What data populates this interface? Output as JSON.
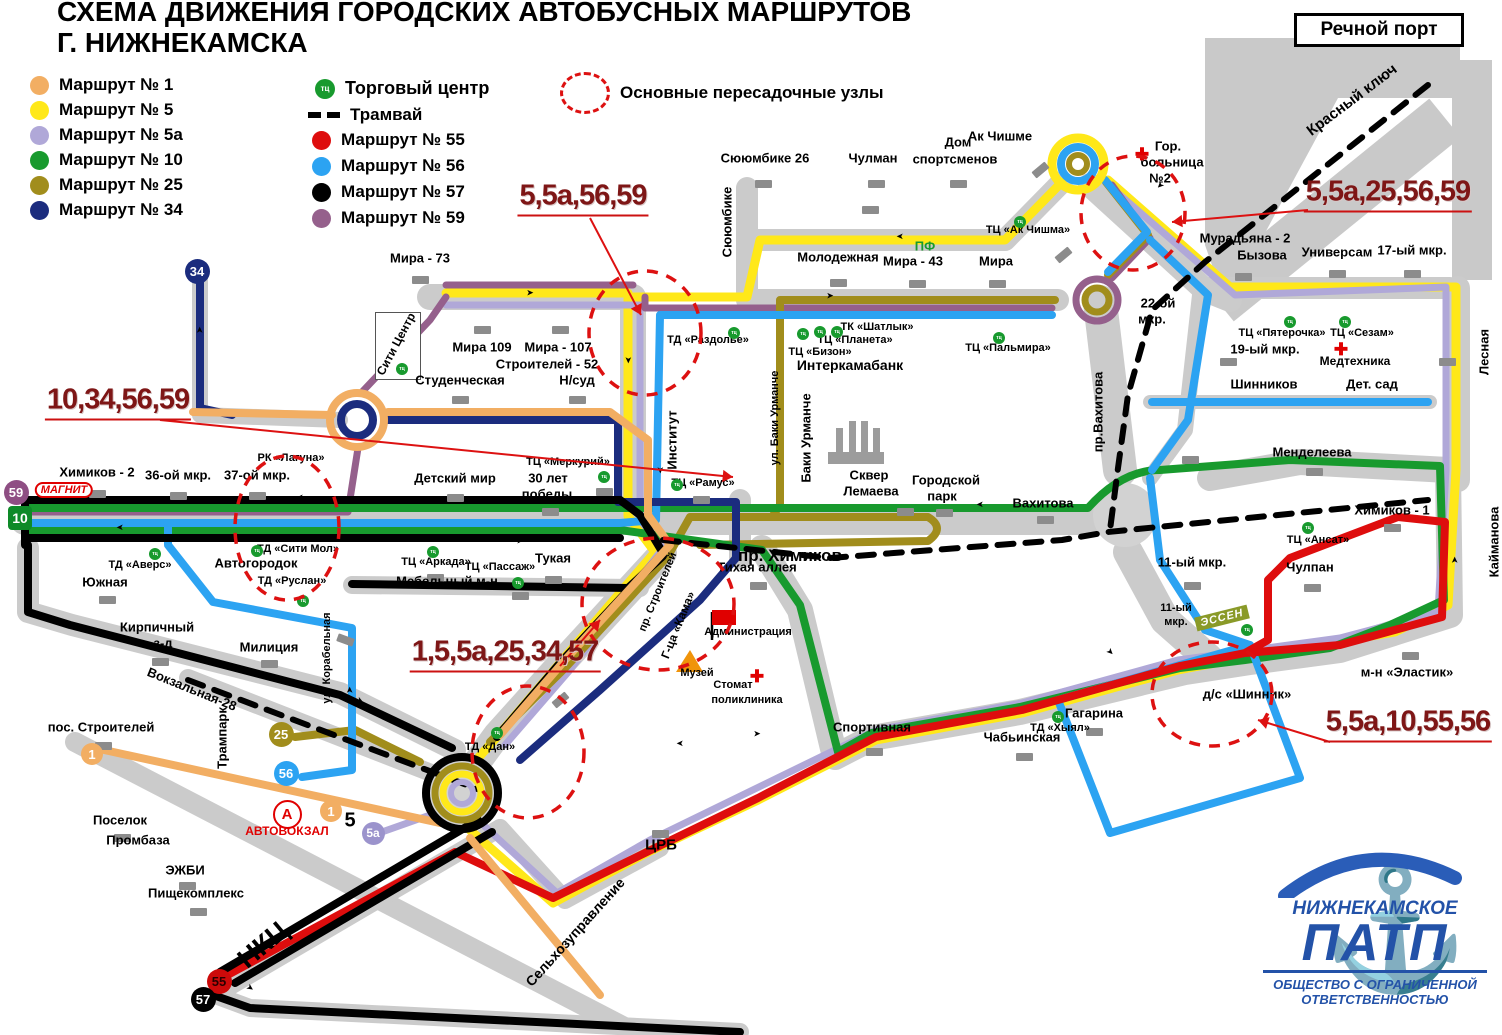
{
  "title": {
    "line1": "СХЕМА ДВИЖЕНИЯ ГОРОДСКИХ АВТОБУСНЫХ МАРШРУТОВ",
    "line2": "Г. НИЖНЕКАМСКА"
  },
  "corner_box": {
    "label": "Речной порт"
  },
  "legend": {
    "routes_col1": [
      {
        "label": "Маршрут № 1",
        "color": "#F2AE63"
      },
      {
        "label": "Маршрут № 5",
        "color": "#FFE819"
      },
      {
        "label": "Маршрут № 5а",
        "color": "#B0A8D8"
      },
      {
        "label": "Маршрут № 10",
        "color": "#189A2E"
      },
      {
        "label": "Маршрут № 25",
        "color": "#A18D1C"
      },
      {
        "label": "Маршрут № 34",
        "color": "#1B2C7E"
      }
    ],
    "routes_col2": [
      {
        "label": "Маршрут № 55",
        "color": "#DE0D0D"
      },
      {
        "label": "Маршрут № 56",
        "color": "#2CA3F2"
      },
      {
        "label": "Маршрут № 57",
        "color": "#000000"
      },
      {
        "label": "Маршрут № 59",
        "color": "#95608C"
      }
    ],
    "tc": {
      "badge": "тц",
      "label": "Торговый центр"
    },
    "tram": {
      "label": "Трамвай"
    },
    "hubs": {
      "label": "Основные пересадочные узлы"
    }
  },
  "junctions": [
    {
      "t": "5,5а,56,59",
      "x": 583,
      "y": 196,
      "ax1": 590,
      "ay1": 218,
      "ax2": 641,
      "ay2": 315
    },
    {
      "t": "10,34,56,59",
      "x": 118,
      "y": 400,
      "ax1": 160,
      "ay1": 420,
      "ax2": 733,
      "ay2": 477
    },
    {
      "t": "1,5,5а,25,34,57",
      "x": 505,
      "y": 652,
      "ax1": 560,
      "ay1": 666,
      "ax2": 600,
      "ay2": 620
    },
    {
      "t": "5,5а,25,56,59",
      "x": 1388,
      "y": 192,
      "ax1": 1308,
      "ay1": 210,
      "ax2": 1172,
      "ay2": 222
    },
    {
      "t": "5,5а,10,55,56",
      "x": 1408,
      "y": 722,
      "ax1": 1330,
      "ay1": 742,
      "ax2": 1258,
      "ay2": 720
    }
  ],
  "hubs": [
    {
      "cx": 645,
      "cy": 333,
      "rx": 56,
      "ry": 62
    },
    {
      "cx": 287,
      "cy": 528,
      "rx": 52,
      "ry": 72
    },
    {
      "cx": 1133,
      "cy": 213,
      "rx": 52,
      "ry": 57
    },
    {
      "cx": 658,
      "cy": 604,
      "rx": 76,
      "ry": 66
    },
    {
      "cx": 528,
      "cy": 752,
      "rx": 56,
      "ry": 66
    },
    {
      "cx": 1212,
      "cy": 694,
      "rx": 60,
      "ry": 52
    }
  ],
  "badges": [
    {
      "t": "34",
      "x": 197,
      "y": 271,
      "bg": "#1B2C7E",
      "fg": "#fff",
      "d": 25,
      "fs": 13
    },
    {
      "t": "59",
      "x": 16,
      "y": 492,
      "bg": "#8E4E83",
      "fg": "#fff",
      "d": 25,
      "fs": 13
    },
    {
      "t": "10",
      "x": 20,
      "y": 518,
      "bg": "#0E8A28",
      "fg": "#fff",
      "d": 24,
      "fs": 14,
      "shape": "rect"
    },
    {
      "t": "25",
      "x": 281,
      "y": 734,
      "bg": "#A18D1C",
      "fg": "#fff",
      "d": 25,
      "fs": 13
    },
    {
      "t": "56",
      "x": 286,
      "y": 773,
      "bg": "#2CA3F2",
      "fg": "#fff",
      "d": 25,
      "fs": 13
    },
    {
      "t": "1",
      "x": 92,
      "y": 754,
      "bg": "#F2AE63",
      "fg": "#fff",
      "d": 22,
      "fs": 13
    },
    {
      "t": "1",
      "x": 331,
      "y": 811,
      "bg": "#F2AE63",
      "fg": "#fff",
      "d": 22,
      "fs": 13
    },
    {
      "t": "5а",
      "x": 373,
      "y": 833,
      "bg": "#9B93CC",
      "fg": "#fff",
      "d": 23,
      "fs": 12
    },
    {
      "t": "А",
      "x": 285,
      "y": 812,
      "bg": "#fff",
      "fg": "#E00000",
      "d": 25,
      "fs": 15,
      "border": "#E00000"
    },
    {
      "t": "55",
      "x": 219,
      "y": 981,
      "bg": "#CC0A0A",
      "fg": "#2A0000",
      "d": 25,
      "fs": 13
    },
    {
      "t": "57",
      "x": 203,
      "y": 999,
      "bg": "#000",
      "fg": "#fff",
      "d": 25,
      "fs": 13
    }
  ],
  "magnit": {
    "t": "МАГНИТ",
    "x": 64,
    "y": 490
  },
  "essen": {
    "t": "ЭССЕН",
    "x": 1222,
    "y": 618
  },
  "labels": [
    {
      "t": "Мира - 73",
      "x": 420,
      "y": 258
    },
    {
      "t": "Сююмбике 26",
      "x": 765,
      "y": 158
    },
    {
      "t": "Чулман",
      "x": 873,
      "y": 158
    },
    {
      "t": "Дом",
      "x": 958,
      "y": 142
    },
    {
      "t": "спортсменов",
      "x": 955,
      "y": 159
    },
    {
      "t": "Ак Чишме",
      "x": 1000,
      "y": 136
    },
    {
      "t": "Гор.",
      "x": 1168,
      "y": 146
    },
    {
      "t": "больница",
      "x": 1172,
      "y": 162
    },
    {
      "t": "№2",
      "x": 1160,
      "y": 178
    },
    {
      "t": "Мурадьяна - 2",
      "x": 1245,
      "y": 238
    },
    {
      "t": "Бызова",
      "x": 1262,
      "y": 255
    },
    {
      "t": "Универсам",
      "x": 1337,
      "y": 252
    },
    {
      "t": "17-ый мкр.",
      "x": 1412,
      "y": 250
    },
    {
      "t": "Красный ключ",
      "x": 1352,
      "y": 100,
      "r": -37,
      "fs": 15
    },
    {
      "t": "Сююмбике",
      "x": 727,
      "y": 222,
      "r": -90
    },
    {
      "t": "Молодежная",
      "x": 838,
      "y": 257
    },
    {
      "t": "ПФ",
      "x": 925,
      "y": 246,
      "c": "#189A2E"
    },
    {
      "t": "Мира - 43",
      "x": 913,
      "y": 261
    },
    {
      "t": "Мира",
      "x": 996,
      "y": 261
    },
    {
      "t": "ТЦ «Ак Чишма»",
      "x": 1028,
      "y": 230,
      "fs": 11
    },
    {
      "t": "22-ой",
      "x": 1158,
      "y": 303
    },
    {
      "t": "мкр.",
      "x": 1152,
      "y": 319
    },
    {
      "t": "ТЦ «Пятерочка»",
      "x": 1282,
      "y": 333,
      "fs": 11
    },
    {
      "t": "ТЦ «Сезам»",
      "x": 1362,
      "y": 333,
      "fs": 11
    },
    {
      "t": "19-ый мкр.",
      "x": 1265,
      "y": 349
    },
    {
      "t": "Медтехника",
      "x": 1355,
      "y": 361,
      "fs": 12
    },
    {
      "t": "Шинников",
      "x": 1264,
      "y": 384
    },
    {
      "t": "Дет. сад",
      "x": 1372,
      "y": 384
    },
    {
      "t": "Лесная",
      "x": 1484,
      "y": 352,
      "r": -90
    },
    {
      "t": "Мира 109",
      "x": 482,
      "y": 347
    },
    {
      "t": "Мира - 107",
      "x": 558,
      "y": 347
    },
    {
      "t": "Строителей - 52",
      "x": 547,
      "y": 364
    },
    {
      "t": "Н/суд",
      "x": 577,
      "y": 380
    },
    {
      "t": "Студенческая",
      "x": 460,
      "y": 380
    },
    {
      "t": "Сити Центр",
      "x": 396,
      "y": 344,
      "r": -62,
      "fs": 12
    },
    {
      "t": "ТД «Раздолье»",
      "x": 708,
      "y": 340,
      "fs": 11
    },
    {
      "t": "ТК «Шатлык»",
      "x": 877,
      "y": 327,
      "fs": 11
    },
    {
      "t": "ТЦ «Планета»",
      "x": 855,
      "y": 340,
      "fs": 11
    },
    {
      "t": "ТЦ «Бизон»",
      "x": 820,
      "y": 352,
      "fs": 11
    },
    {
      "t": "Интеркамабанк",
      "x": 850,
      "y": 365,
      "fs": 14
    },
    {
      "t": "ТЦ «Пальмира»",
      "x": 1008,
      "y": 348,
      "fs": 11
    },
    {
      "t": "пр.Вахитова",
      "x": 1098,
      "y": 412,
      "r": -90
    },
    {
      "t": "Институт",
      "x": 672,
      "y": 440,
      "r": -90
    },
    {
      "t": "ул. Баки Урманче",
      "x": 775,
      "y": 418,
      "r": -90,
      "fs": 11
    },
    {
      "t": "Баки Урманче",
      "x": 806,
      "y": 438,
      "r": -90
    },
    {
      "t": "ТЦ «Рамус»",
      "x": 703,
      "y": 483,
      "fs": 11
    },
    {
      "t": "ТЦ «Меркурий»",
      "x": 568,
      "y": 462,
      "fs": 11
    },
    {
      "t": "30 лет",
      "x": 548,
      "y": 478
    },
    {
      "t": "победы",
      "x": 547,
      "y": 494
    },
    {
      "t": "Детский мир",
      "x": 455,
      "y": 478
    },
    {
      "t": "Химиков - 2",
      "x": 97,
      "y": 472
    },
    {
      "t": "36-ой мкр.",
      "x": 178,
      "y": 475
    },
    {
      "t": "37-ой мкр.",
      "x": 257,
      "y": 475
    },
    {
      "t": "РК «Лагуна»",
      "x": 291,
      "y": 458,
      "fs": 11
    },
    {
      "t": "ТД «Сити Мол»",
      "x": 298,
      "y": 549,
      "fs": 11
    },
    {
      "t": "Автогородок",
      "x": 256,
      "y": 563
    },
    {
      "t": "ТД «Аверс»",
      "x": 140,
      "y": 565,
      "fs": 11
    },
    {
      "t": "ТД «Руслан»",
      "x": 292,
      "y": 581,
      "fs": 11
    },
    {
      "t": "Южная",
      "x": 105,
      "y": 582
    },
    {
      "t": "Кирпичный",
      "x": 157,
      "y": 627
    },
    {
      "t": "з-д",
      "x": 163,
      "y": 643
    },
    {
      "t": "Милиция",
      "x": 269,
      "y": 647
    },
    {
      "t": "ул. Корабельная",
      "x": 327,
      "y": 658,
      "r": -90,
      "fs": 11
    },
    {
      "t": "Вокзальная-28",
      "x": 192,
      "y": 689,
      "r": 22
    },
    {
      "t": "Трампарк",
      "x": 222,
      "y": 738,
      "r": -90
    },
    {
      "t": "пос. Строителей",
      "x": 101,
      "y": 727
    },
    {
      "t": "Тукая",
      "x": 553,
      "y": 558
    },
    {
      "t": "ТЦ «Аркада»",
      "x": 436,
      "y": 562,
      "fs": 11
    },
    {
      "t": "ТЦ «Пассаж»",
      "x": 500,
      "y": 567,
      "fs": 11
    },
    {
      "t": "Мебельный м-н",
      "x": 447,
      "y": 581
    },
    {
      "t": "Тихая аллея",
      "x": 757,
      "y": 567
    },
    {
      "t": "пр. Химиков",
      "x": 790,
      "y": 556,
      "fs": 17
    },
    {
      "t": "пр. Строителей",
      "x": 658,
      "y": 592,
      "r": -68,
      "fs": 11
    },
    {
      "t": "Г-ца «Кама»",
      "x": 678,
      "y": 625,
      "r": -68,
      "fs": 12
    },
    {
      "t": "Администрация",
      "x": 748,
      "y": 632,
      "fs": 11
    },
    {
      "t": "Музей",
      "x": 697,
      "y": 673,
      "fs": 11
    },
    {
      "t": "Стомат",
      "x": 733,
      "y": 685,
      "fs": 11
    },
    {
      "t": "поликлиника",
      "x": 747,
      "y": 700,
      "fs": 11
    },
    {
      "t": "Сквер",
      "x": 869,
      "y": 475
    },
    {
      "t": "Лемаева",
      "x": 871,
      "y": 491
    },
    {
      "t": "Городской",
      "x": 946,
      "y": 480
    },
    {
      "t": "парк",
      "x": 942,
      "y": 496
    },
    {
      "t": "Вахитова",
      "x": 1043,
      "y": 503
    },
    {
      "t": "Менделеева",
      "x": 1312,
      "y": 452
    },
    {
      "t": "11-ый мкр.",
      "x": 1192,
      "y": 562
    },
    {
      "t": "11-ый",
      "x": 1176,
      "y": 608,
      "fs": 11
    },
    {
      "t": "мкр.",
      "x": 1176,
      "y": 622,
      "fs": 11
    },
    {
      "t": "ТЦ «Ансат»",
      "x": 1318,
      "y": 540,
      "fs": 11
    },
    {
      "t": "Химиков - 1",
      "x": 1392,
      "y": 510
    },
    {
      "t": "Чулпан",
      "x": 1310,
      "y": 567
    },
    {
      "t": "Кайманова",
      "x": 1494,
      "y": 542,
      "r": -90
    },
    {
      "t": "м-н «Эластик»",
      "x": 1407,
      "y": 672
    },
    {
      "t": "д/с «Шинник»",
      "x": 1247,
      "y": 694
    },
    {
      "t": "Гагарина",
      "x": 1094,
      "y": 713
    },
    {
      "t": "ТД «Хыял»",
      "x": 1060,
      "y": 728,
      "fs": 11
    },
    {
      "t": "Чабьинская",
      "x": 1022,
      "y": 737
    },
    {
      "t": "Спортивная",
      "x": 872,
      "y": 727
    },
    {
      "t": "ЦРБ",
      "x": 661,
      "y": 845,
      "fs": 15
    },
    {
      "t": "Сельхозуправление",
      "x": 575,
      "y": 932,
      "r": -48,
      "fs": 14
    },
    {
      "t": "НКЦ",
      "x": 263,
      "y": 945,
      "r": -40,
      "fs": 27
    },
    {
      "t": "Поселок",
      "x": 120,
      "y": 820
    },
    {
      "t": "Промбаза",
      "x": 138,
      "y": 840
    },
    {
      "t": "ЭЖБИ",
      "x": 185,
      "y": 870
    },
    {
      "t": "Пищекомплекс",
      "x": 196,
      "y": 893
    },
    {
      "t": "АВТОВОКЗАЛ",
      "x": 287,
      "y": 831,
      "fs": 12,
      "c": "#E00000"
    },
    {
      "t": "ТД «Дан»",
      "x": 490,
      "y": 747,
      "fs": 11
    },
    {
      "t": "5",
      "x": 350,
      "y": 821,
      "fs": 20
    }
  ],
  "tc_dots": [
    {
      "x": 402,
      "y": 369
    },
    {
      "x": 734,
      "y": 333
    },
    {
      "x": 803,
      "y": 334
    },
    {
      "x": 820,
      "y": 332
    },
    {
      "x": 837,
      "y": 332
    },
    {
      "x": 999,
      "y": 338
    },
    {
      "x": 1020,
      "y": 222
    },
    {
      "x": 1290,
      "y": 322
    },
    {
      "x": 1345,
      "y": 322
    },
    {
      "x": 677,
      "y": 485
    },
    {
      "x": 604,
      "y": 477
    },
    {
      "x": 257,
      "y": 551
    },
    {
      "x": 155,
      "y": 554
    },
    {
      "x": 303,
      "y": 601
    },
    {
      "x": 433,
      "y": 552
    },
    {
      "x": 518,
      "y": 583
    },
    {
      "x": 1308,
      "y": 528
    },
    {
      "x": 1058,
      "y": 717
    },
    {
      "x": 497,
      "y": 733
    },
    {
      "x": 1247,
      "y": 630
    }
  ],
  "crosses": [
    {
      "x": 1142,
      "y": 155
    },
    {
      "x": 1341,
      "y": 350
    },
    {
      "x": 757,
      "y": 677
    }
  ],
  "ticks": [
    {
      "x": 420,
      "y": 280
    },
    {
      "x": 763,
      "y": 184
    },
    {
      "x": 876,
      "y": 184
    },
    {
      "x": 958,
      "y": 184
    },
    {
      "x": 1040,
      "y": 170,
      "r": -40
    },
    {
      "x": 1243,
      "y": 277
    },
    {
      "x": 1337,
      "y": 274
    },
    {
      "x": 1412,
      "y": 274
    },
    {
      "x": 838,
      "y": 283
    },
    {
      "x": 917,
      "y": 284
    },
    {
      "x": 997,
      "y": 284
    },
    {
      "x": 1063,
      "y": 255,
      "r": -40
    },
    {
      "x": 482,
      "y": 330
    },
    {
      "x": 560,
      "y": 330
    },
    {
      "x": 577,
      "y": 400
    },
    {
      "x": 460,
      "y": 400
    },
    {
      "x": 97,
      "y": 494
    },
    {
      "x": 178,
      "y": 496
    },
    {
      "x": 257,
      "y": 496
    },
    {
      "x": 701,
      "y": 500
    },
    {
      "x": 604,
      "y": 492
    },
    {
      "x": 550,
      "y": 512
    },
    {
      "x": 455,
      "y": 498
    },
    {
      "x": 435,
      "y": 578
    },
    {
      "x": 520,
      "y": 596
    },
    {
      "x": 553,
      "y": 580
    },
    {
      "x": 758,
      "y": 586
    },
    {
      "x": 905,
      "y": 512
    },
    {
      "x": 944,
      "y": 513
    },
    {
      "x": 1045,
      "y": 520
    },
    {
      "x": 1192,
      "y": 586
    },
    {
      "x": 1314,
      "y": 472
    },
    {
      "x": 1392,
      "y": 528
    },
    {
      "x": 1312,
      "y": 588
    },
    {
      "x": 1410,
      "y": 656
    },
    {
      "x": 1094,
      "y": 732
    },
    {
      "x": 1024,
      "y": 757
    },
    {
      "x": 874,
      "y": 752
    },
    {
      "x": 660,
      "y": 834
    },
    {
      "x": 560,
      "y": 700,
      "r": -40
    },
    {
      "x": 269,
      "y": 664
    },
    {
      "x": 160,
      "y": 662
    },
    {
      "x": 107,
      "y": 600
    },
    {
      "x": 103,
      "y": 746
    },
    {
      "x": 122,
      "y": 838
    },
    {
      "x": 187,
      "y": 886
    },
    {
      "x": 198,
      "y": 912
    },
    {
      "x": 1228,
      "y": 362
    },
    {
      "x": 870,
      "y": 210
    },
    {
      "x": 1447,
      "y": 362
    },
    {
      "x": 1190,
      "y": 460
    },
    {
      "x": 345,
      "y": 640,
      "r": 20
    }
  ],
  "dir_arrows": [
    {
      "x": 300,
      "y": 497,
      "r": 180
    },
    {
      "x": 520,
      "y": 541,
      "r": 0
    },
    {
      "x": 830,
      "y": 296,
      "r": 0
    },
    {
      "x": 900,
      "y": 236,
      "r": 180
    },
    {
      "x": 530,
      "y": 293,
      "r": 0
    },
    {
      "x": 980,
      "y": 504,
      "r": 180
    },
    {
      "x": 757,
      "y": 734,
      "r": 0
    },
    {
      "x": 680,
      "y": 743,
      "r": 180
    },
    {
      "x": 360,
      "y": 701,
      "r": 25
    },
    {
      "x": 250,
      "y": 988,
      "r": 35
    },
    {
      "x": 1455,
      "y": 560,
      "r": -90
    },
    {
      "x": 1110,
      "y": 652,
      "r": 45
    },
    {
      "x": 628,
      "y": 360,
      "r": 90
    },
    {
      "x": 660,
      "y": 470,
      "r": 90
    },
    {
      "x": 200,
      "y": 330,
      "r": -90
    },
    {
      "x": 1160,
      "y": 185,
      "r": 135
    },
    {
      "x": 350,
      "y": 690,
      "r": -90
    },
    {
      "x": 120,
      "y": 527,
      "r": 180
    }
  ],
  "logo": {
    "line1": "НИЖНЕКАМСКОЕ",
    "line2": "ПАТП",
    "line3": "ОБЩЕСТВО С ОГРАНИЧЕННОЙ",
    "line4": "ОТВЕТСТВЕННОСТЬЮ"
  },
  "colors": {
    "r1": "#F2AE63",
    "r5": "#FFE819",
    "r5a": "#B0A8D8",
    "r10": "#189A2E",
    "r25": "#A18D1C",
    "r34": "#1B2C7E",
    "r55": "#DE0D0D",
    "r56": "#2CA3F2",
    "r57": "#000000",
    "r59": "#95608C",
    "road": "#CBCBCB",
    "hub": "#DD1111"
  }
}
